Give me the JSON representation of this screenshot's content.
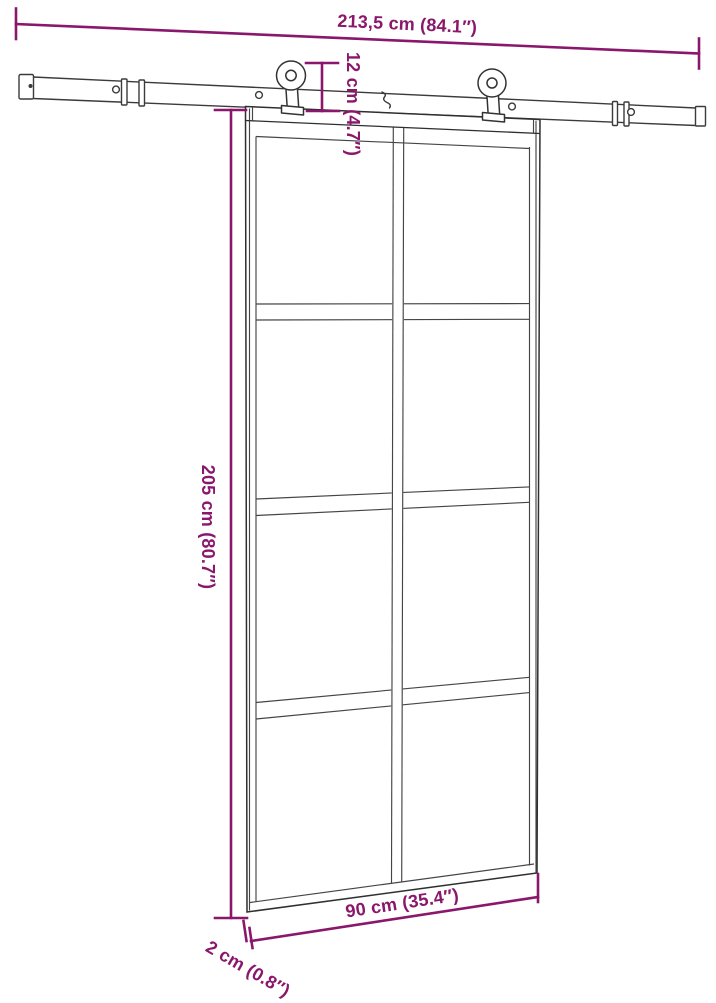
{
  "figure": {
    "kind": "product-dimension-diagram",
    "subject": "sliding glass door with barn-style rail hardware",
    "background": "#FFFFFF"
  },
  "colors": {
    "dimension_accent": "#8A176C",
    "line_art": "#3B3B3B",
    "frame_dark": "#2F2F2F"
  },
  "annotations": {
    "rail_length": "213,5 cm (84.1″)",
    "hardware_height": "12 cm (4.7″)",
    "door_height": "205 cm (80.7″)",
    "door_width": "90 cm (35.4″)",
    "door_thickness": "2 cm (0.8″)"
  }
}
